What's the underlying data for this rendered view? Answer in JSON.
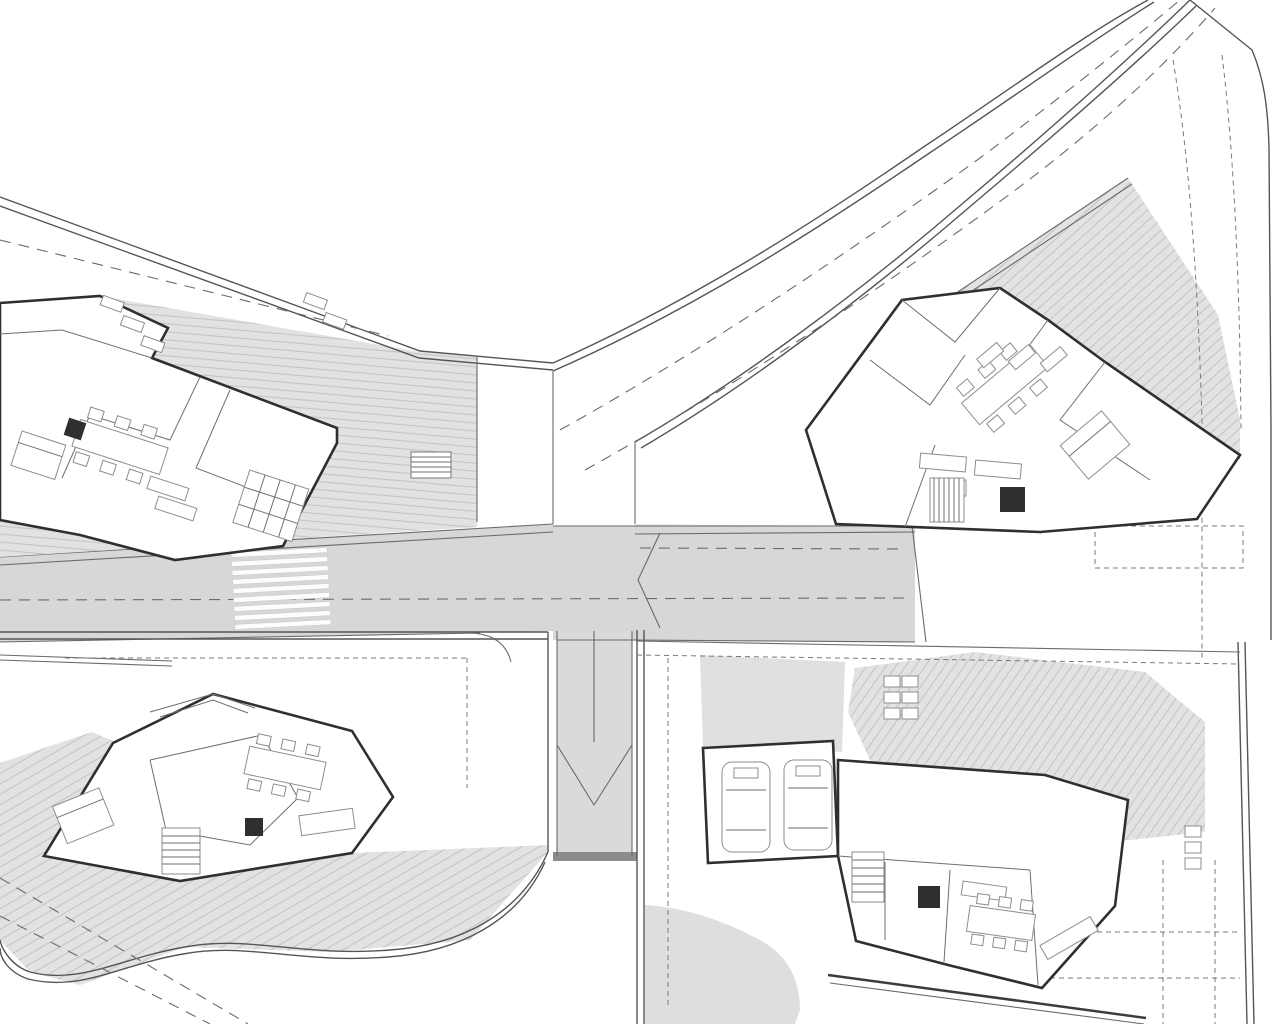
{
  "meta": {
    "drawing_type": "architectural site plan",
    "description": "Master plan of four modern villas with swimming pools, access roads, driveway ramp and landscaping",
    "visible_text": "none — only tiny illegible dimension labels",
    "villas": [
      {
        "name": "villa-top-left"
      },
      {
        "name": "villa-top-right"
      },
      {
        "name": "villa-bottom-left"
      },
      {
        "name": "villa-bottom-right"
      }
    ]
  },
  "palette": {
    "pool": "#57e3c8",
    "pooledge": "#4d9a8a",
    "pooldark": "#2ba38c",
    "terrace": "#e2e2e2",
    "hatch": "#c4c4c4",
    "road": "#d7d7d7",
    "ramp": "#dadada",
    "line": "#6a6a6a",
    "wall": "#2f2f2f",
    "boundary": "#555555",
    "tree": "#9ab77c",
    "treedark": "#85a568",
    "chip": "#b9b9b9"
  },
  "pools": [
    {
      "name": "pool-villa-top-left",
      "points": "167,337 445,421 447,453 340,453 272,386 169,351",
      "steps": [],
      "stripes": [],
      "dash": null
    },
    {
      "name": "pool-villa-top-right",
      "points": "1120,183 1083,242 1143,372 1181,430 1217,316",
      "steps": [
        [
          1141,
          368,
          1196,
          355
        ],
        [
          1143,
          376,
          1198,
          363
        ],
        [
          1145,
          384,
          1199,
          371
        ],
        [
          1150,
          392,
          1196,
          381
        ],
        [
          1155,
          401,
          1193,
          391
        ],
        [
          1160,
          410,
          1190,
          402
        ],
        [
          1166,
          418,
          1186,
          412
        ]
      ],
      "stripes": [],
      "dash": null
    },
    {
      "name": "pool-villa-bottom-left",
      "points": "2,667 165,673 90,733 0,763",
      "steps": [
        [
          18,
          708,
          105,
          712
        ],
        [
          25,
          714,
          108,
          718
        ],
        [
          32,
          720,
          111,
          724
        ],
        [
          39,
          726,
          112,
          730
        ],
        [
          46,
          732,
          110,
          736
        ]
      ],
      "stripes": [
        [
          2,
          662,
          172,
          668
        ],
        [
          2,
          657,
          172,
          663
        ]
      ],
      "dash": null
    },
    {
      "name": "pool-villa-bottom-right",
      "points": "975,657 1143,677 1201,728 1201,777 1128,777 1128,742 1070,737 975,730",
      "steps": [
        [
          1131,
          746,
          1198,
          746
        ],
        [
          1131,
          750,
          1198,
          750
        ],
        [
          1131,
          754,
          1198,
          754
        ],
        [
          1131,
          758,
          1198,
          758
        ],
        [
          1131,
          762,
          1198,
          762
        ],
        [
          1131,
          766,
          1198,
          766
        ],
        [
          1131,
          770,
          1198,
          770
        ],
        [
          1131,
          774,
          1198,
          774
        ],
        [
          1163,
          743,
          1163,
          777
        ]
      ],
      "stripes": [
        [
          977,
          661,
          1141,
          681
        ],
        [
          977,
          664,
          1140,
          684
        ],
        [
          978,
          667,
          1138,
          687
        ],
        [
          1141,
          681,
          1196,
          729
        ],
        [
          1140,
          684,
          1194,
          732
        ]
      ],
      "dash": [
        980,
        707,
        1196,
        707
      ]
    }
  ],
  "trees": {
    "palms": [
      [
        497,
        471,
        24
      ],
      [
        235,
        444,
        26
      ],
      [
        613,
        451,
        28
      ],
      [
        730,
        424,
        24
      ],
      [
        920,
        312,
        28
      ],
      [
        1087,
        135,
        25
      ],
      [
        1123,
        70,
        26
      ],
      [
        1133,
        30,
        26
      ],
      [
        780,
        673,
        22
      ],
      [
        575,
        985,
        26
      ],
      [
        950,
        1000,
        28
      ],
      [
        1188,
        997,
        24
      ],
      [
        1198,
        907,
        23
      ],
      [
        1030,
        965,
        26
      ],
      [
        343,
        810,
        28
      ],
      [
        235,
        655,
        20
      ],
      [
        660,
        862,
        22
      ]
    ],
    "rounds": [
      [
        63,
        277,
        13
      ],
      [
        515,
        403,
        26
      ],
      [
        523,
        478,
        14
      ],
      [
        650,
        447,
        15
      ],
      [
        822,
        375,
        21
      ],
      [
        1005,
        188,
        25
      ],
      [
        142,
        514,
        10
      ],
      [
        195,
        516,
        8
      ],
      [
        200,
        646,
        24
      ],
      [
        353,
        727,
        27
      ],
      [
        672,
        672,
        22
      ],
      [
        672,
        757,
        20
      ],
      [
        745,
        995,
        27
      ],
      [
        1108,
        975,
        24
      ]
    ],
    "shrubs": [
      [
        48,
        910,
        10
      ],
      [
        57,
        934,
        9
      ],
      [
        66,
        956,
        9
      ]
    ]
  },
  "chips": [
    [
      15,
      247
    ],
    [
      355,
      478
    ],
    [
      432,
      526
    ],
    [
      862,
      563
    ],
    [
      1040,
      646
    ],
    [
      925,
      733
    ],
    [
      1133,
      912
    ],
    [
      480,
      656
    ],
    [
      765,
      612
    ],
    [
      527,
      680
    ],
    [
      300,
      640
    ],
    [
      1052,
      302
    ],
    [
      713,
      490
    ],
    [
      680,
      560
    ]
  ]
}
